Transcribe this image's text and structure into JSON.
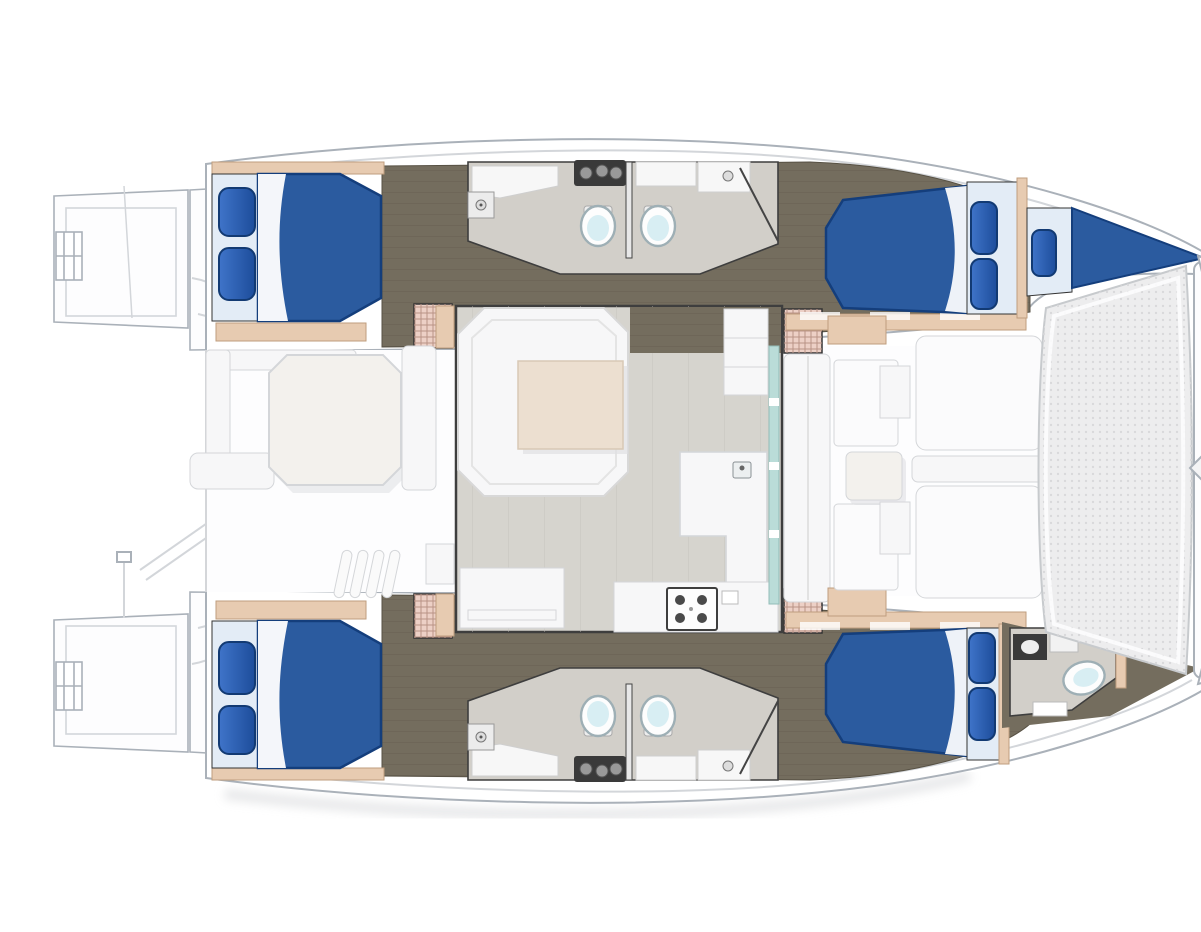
{
  "title": "Catamaran yacht deck and accommodation floor plan, top view, bow to the right",
  "areas": {
    "plan": "Catamaran floor plan",
    "stern_platform_top": "Starboard stern swim platform with boarding ladder",
    "stern_platform_bottom": "Port stern swim platform with boarding ladder",
    "transom_steps_top": "Starboard transom steps",
    "transom_steps_bottom": "Port transom steps",
    "aft_cockpit": "Aft cockpit with dining table, benches and steps",
    "saloon": "Saloon with U-shaped settee, table, galley and front glass door",
    "hull_top": "Starboard hull: aft double cabin, two bathrooms, forward double cabin and forepeak berth",
    "hull_bottom": "Port hull: aft double cabin, two bathrooms, forward double cabin and forward bathroom",
    "forward_cockpit": "Forward cockpit lounge with table",
    "foredeck": "Foredeck sun pads and walkway",
    "trampoline": "Bow trampoline net with crossbeam"
  },
  "inventory": {
    "double_berths": 4,
    "single_berths": 1,
    "toilets": 5,
    "bathrooms": 5,
    "tables": 3
  },
  "colors": {
    "hull_line": "#aab1b9",
    "deck_line": "#d3d6da",
    "deck_fill": "#fdfdfe",
    "panel_fill": "#f7f7f8",
    "panel_line": "#d4d6d9",
    "shadow": "#dfe0e2",
    "bed": "#2b5b9f",
    "bed_line": "#143e7c",
    "pillow_hi": "#3f74c9",
    "pillow_lo": "#1d4d9b",
    "pillow_line": "#123a73",
    "sheet": "#e3ecf6",
    "walnut": "#746d5e",
    "walnut_line": "#575144",
    "tan": "#e7cbb1",
    "tan_line": "#bf9e7e",
    "step": "#edd0c6",
    "step_line": "#b99386",
    "bath_floor": "#d2cfc9",
    "saloon_floor": "#d6d4ce",
    "plank_line": "#c4c1bb",
    "wall_dark": "#3e3e3e",
    "fixture_dark": "#3a3a3a",
    "knob": "#999999",
    "toilet_rim": "#9eafb5",
    "toilet_seat": "#d8eef3",
    "glass": "#badcd8",
    "glass_line": "#93bdb8",
    "table_cream": "#ecdfd0",
    "table_cream_line": "#d8c9b6",
    "cockpit_table": "#f3f1ed",
    "tramp": "#ededee",
    "tramp_dot": "#d9d9db",
    "tramp_line": "#c7cacd"
  }
}
